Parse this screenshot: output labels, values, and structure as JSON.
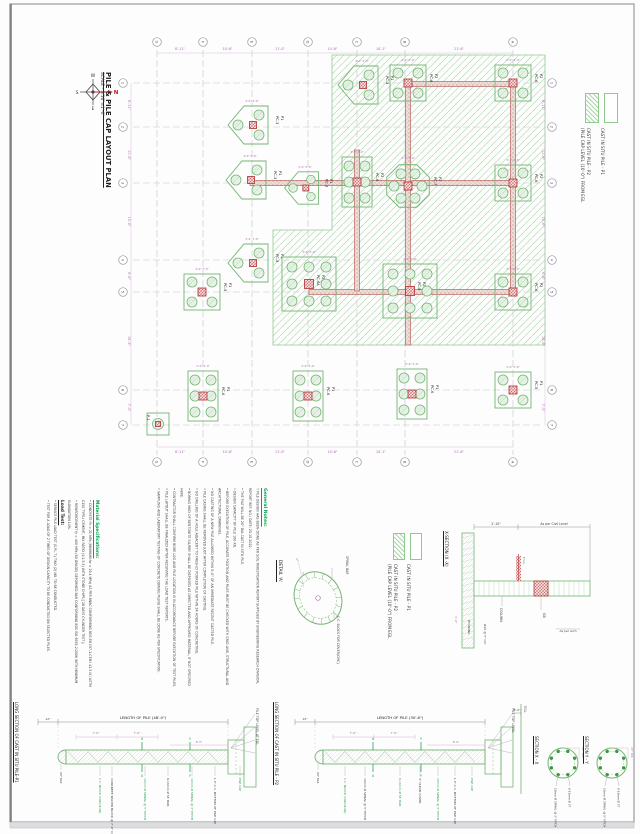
{
  "sheet": {
    "title": "PILE & PILE CAP LAYOUT PLAN",
    "scale": "SCALE - 3/16\"=1'-0\"",
    "compass": {
      "n": "N",
      "s": "S",
      "e": "E",
      "w": "W"
    }
  },
  "colors": {
    "green_line": "#74b474",
    "zone_hatch": "#b7ddb7",
    "heading_green": "#00a550",
    "dim_purple": "#b06ab0",
    "beam_red": "#b05050",
    "grid_gray": "#c6c6cc",
    "text_dark": "#333333"
  },
  "legend": {
    "p1_label": "CAST IN SITU PILE - P1",
    "p2_label": "CAST IN SITU PILE - P2",
    "p2_sub": "(PILE CAP LEVEL (10'-0\") FROM EGL"
  },
  "plan": {
    "cols": [
      {
        "l": "G",
        "x": 157
      },
      {
        "l": "F",
        "x": 203
      },
      {
        "l": "E",
        "x": 252
      },
      {
        "l": "D",
        "x": 308
      },
      {
        "l": "C",
        "x": 357
      },
      {
        "l": "B",
        "x": 405
      },
      {
        "l": "A",
        "x": 513
      }
    ],
    "colDims": [
      "8'-11\"",
      "10'-6\"",
      "11'-0\"",
      "10'-6\"",
      "10'-1\"",
      "21'-6\""
    ],
    "rows": [
      {
        "l": "1",
        "y": 83
      },
      {
        "l": "2",
        "y": 127
      },
      {
        "l": "3",
        "y": 183
      },
      {
        "l": "4",
        "y": 260
      },
      {
        "l": "5",
        "y": 292
      },
      {
        "l": "6",
        "y": 390
      },
      {
        "l": "7",
        "y": 425
      }
    ],
    "rowDims": [
      "8'-11\"",
      "11'-6\"",
      "15'-6\"",
      "6'-6\"",
      "19'-6\"",
      "7'-3\""
    ],
    "capDim": "3'-0\"",
    "hatch": [
      [
        332,
        55
      ],
      [
        545,
        55
      ],
      [
        545,
        345
      ],
      [
        273,
        345
      ],
      [
        273,
        230
      ],
      [
        332,
        230
      ]
    ],
    "beams": [
      [
        250,
        183,
        513,
        183
      ],
      [
        309,
        292,
        513,
        292
      ],
      [
        408,
        84,
        513,
        84
      ],
      [
        357,
        150,
        357,
        291
      ],
      [
        408,
        84,
        408,
        345
      ],
      [
        513,
        84,
        513,
        292
      ]
    ],
    "caps": [
      {
        "t": "pent3",
        "x": 252,
        "y": 125,
        "p": "P1",
        "c": "PC-3"
      },
      {
        "t": "pent3",
        "x": 250,
        "y": 180,
        "p": "P1",
        "c": "PC-3"
      },
      {
        "t": "pent3",
        "x": 305,
        "y": 188,
        "p": "P1",
        "c": "PC-3",
        "s": 0.85
      },
      {
        "t": "pent3",
        "x": 362,
        "y": 85,
        "p": "P1",
        "c": "PC-3"
      },
      {
        "t": "pent3",
        "x": 252,
        "y": 263,
        "p": "P1",
        "c": "PC-3"
      },
      {
        "t": "sq4",
        "x": 408,
        "y": 83,
        "p": "P2",
        "c": "PC-6"
      },
      {
        "t": "sq4",
        "x": 513,
        "y": 83,
        "p": "P2",
        "c": "PC-6"
      },
      {
        "t": "sq4",
        "x": 513,
        "y": 183,
        "p": "P2",
        "c": "PC-6"
      },
      {
        "t": "sq4",
        "x": 513,
        "y": 292,
        "p": "P2",
        "c": "PC-6"
      },
      {
        "t": "sq4",
        "x": 513,
        "y": 390,
        "p": "P1",
        "c": "PC-5"
      },
      {
        "t": "rect6",
        "x": 357,
        "y": 182,
        "p": "P2",
        "c": "PC-6"
      },
      {
        "t": "oct7",
        "x": 408,
        "y": 186,
        "p": "P2",
        "c": "PC-7"
      },
      {
        "t": "sq9",
        "x": 410,
        "y": 291,
        "p": "P2",
        "c": "PC-9"
      },
      {
        "t": "sq9",
        "x": 309,
        "y": 284,
        "p": "P2",
        "c": "PC-6A"
      },
      {
        "t": "sq4",
        "x": 202,
        "y": 292,
        "p": "P1",
        "c": "PC-5"
      },
      {
        "t": "rect6",
        "x": 203,
        "y": 396,
        "p": "P1",
        "c": "PC-6"
      },
      {
        "t": "rect6",
        "x": 308,
        "y": 396,
        "p": "P1",
        "c": "PC-6"
      },
      {
        "t": "rect6",
        "x": 412,
        "y": 394,
        "p": "P1",
        "c": "PC-6"
      },
      {
        "t": "single",
        "x": 158,
        "y": 424,
        "p": "P-1",
        "c": ""
      }
    ]
  },
  "notes": {
    "heading": "General Notes:",
    "items": [
      "PILE DESIGN HAS BEEN DONE AS PER SOIL INVESTIGATION REPORT SUPPLIED BY ENGINEERING RESEARCH DIVISION, REPORT REF. NO./ DATE: 25.10.2022.",
      "THE PILE WILL BE 20\" DIA CAST IN SITU PILE.",
      "DESIGN CAPACITY OF PILE 100 KN.",
      "BEFORE EXECUTION OF PILE, ACCURATE POSITION AND PILES MUST BE CHECKED WITH GRID LINE, STRUCTURAL AND ARCHITECTURAL DRAWINGS.",
      "NO CASTING OF A NEW PILE ALLOWED WITHIN 5'-0\" OF AN IMMEDIATE RECENT CASTED PILE.",
      "PILE CASING SHALL BE REMOVED JUST AFTER COMPLETION OF CASTING.",
      "NO DRILLING OF A HOLE ADJACENT TO FRESHLY POURED PILE WITHIN 24 HOURS OF CONCRETING.",
      "BORING MUD OF BENTONITE SLURRY SHALL BE DISPOSED AS DIRECTED AND APPROVED MATERIAL, IF NOT SPECIFIED HERE.",
      "CONTRACTOR SHALL CONFIRM BORE LOG AND PILE LOCATION IS IN ACCORDANCE BEFORE EXECUTION OF TEST PILES.",
      "PILE LAYOUT SHALL BE FINALIZED AFTER RECEIVING THE LOAD TEST REPORTS.",
      "SAMPLING AND LABORATORY TESTING OF CONCRETE DURING PILING SHALL BE DONE AS PER SPECIFICATION."
    ]
  },
  "materials": {
    "heading": "Material Specifications:",
    "items": [
      "CONCRETE f'c = 21 MPa (MINIMUM fcr = 29.4 MPa) AS PER BNBC CONFORMING BDS EN 197-1-CEM I 42.5 N / ASTM C150 TYPE-I CEMENT, MIX RATIO (1:1.5:3) WITH STONE CHIPS [ 28 DAYS CYLINDER TEST ].",
      "REINFORCEMENT fy = 400 MPa (60 GRADE) DEFORMED BAR CONFORMING BDS ISO 6935-2:2006 WITH MINIMUM ELONGATION 14%."
    ]
  },
  "load_test": {
    "heading": "Load Test:",
    "items": [
      "SERVICE PILE LOAD TEST (S.P.L.T.) TWO (2) NO. TO BE CONDUCTED.",
      "TEST FOR A LOAD OF 2 TIMES OF DESIGN CAPACITY TO BE CONDUCTED ON SELECTED PILES."
    ]
  },
  "detail_a": {
    "title": "DETAIL 'A'",
    "label_spiral": "SPIRAL BAR",
    "label_block": "C.C. BLOCK FOR COVER(CIRC)",
    "dims": [
      "3\"",
      "5\""
    ]
  },
  "x_section": {
    "title": "X-SECTION (X -X)",
    "dim_left": "2'-10\"",
    "dim_right": "As per Civil Level",
    "fgl": "F.G.L.",
    "column": "COLUMN",
    "gb": "GB",
    "stirrup": "Ø10 @ 5\" C/C",
    "hooking": "HOOKING",
    "arch": "As per arch",
    "depth": "3'-0\""
  },
  "long_p1": {
    "title": "LONG SECTION OF CAST IN SITU PILE-P1",
    "length": "LENGTH OF PILE (48'-0\")",
    "left_dim": "12\"",
    "dia": "20\" DIA",
    "sub_dims": [
      "7'-6\"",
      "7'-6\""
    ],
    "markers": [
      "X",
      "Y"
    ],
    "bot_labels": [
      "C.C. BLOCK (CIRCULAR)",
      "CONCRETE SPACER BLOCK @ 7'-6\" C/C",
      "10mm Ø SPIRAL @ 5\" PITCH",
      "8-16mm Ø ST. BAR",
      "10mm Ø SPIRAL @ 3\" PITCH",
      "L 3\"-C.C. BOTTOM OF PILE CAP",
      "PILE CAP"
    ],
    "top_right": "PILE TOP LEVEL AT EGL",
    "cap_dim": "8'-0\""
  },
  "long_p2": {
    "title": "LONG SECTION OF CAST IN SITU PILE - P2",
    "length": "LENGTH OF PILE (30'-6\")",
    "left_dim": "12\"",
    "dia": "20\" DIA",
    "sub_dims": [
      "7'-6\"",
      "7'-6\""
    ],
    "markers": [
      "X",
      "Y"
    ],
    "bot_labels": [
      "C.C. BLOCK (CIRCULAR)",
      "10mm Ø SPIRAL @ 5\" PITCH",
      "8-16mm Ø ST. BAR",
      "4\" CLEAR COVER",
      "10mm Ø SPIRAL @ 3\" PITCH",
      "L 3\"-C.C. BOTTOM OF PILE CAP",
      "PILE CAP"
    ],
    "top_right": "PILE TOP LEVEL",
    "egl": "EGL",
    "egl_dim": "5'-0\"",
    "cap_dim": "8'-0\""
  },
  "section_xx": {
    "title": "SECTION X - X",
    "bar": "8-16mm Ø ST",
    "spiral": "10mm Ø SPIRAL @ 3\" PITCH",
    "dia": "20\" DIA"
  },
  "section_yy": {
    "title": "SECTION Y - Y",
    "bar": "8-16mm Ø ST",
    "spiral": "10mm Ø SPIRAL @ 5\" PITCH",
    "dia": "20\" DIA"
  }
}
